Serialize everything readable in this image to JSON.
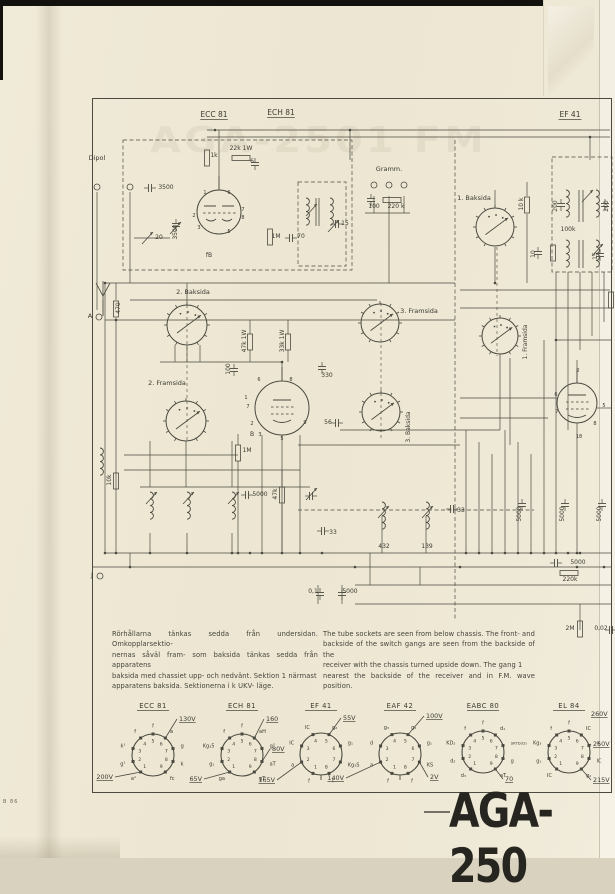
{
  "page": {
    "model": "AGA-250",
    "edge_code": "B 86",
    "bleed_text": "AGA-2501 FM"
  },
  "notes": {
    "swedish": "Rörhållarna tänkas sedda från undersidan. Omkopplarsektio-\nnernas såväl fram- som baksida tänkas sedda från apparatens\nbaksida med chassiet upp- och nedvänt.  Sektion 1 närmast\napparatens baksida.  Sektionerna i k  UKV- läge.",
    "english": "The tube sockets are seen from below chassis. The front- and\nbackside of the switch gangs are seen from the backside of the\nreceiver with the chassis turned upside down.  The gang 1\nnearest the backside of the receiver and in F.M. wave position."
  },
  "schematic": {
    "labels": [
      {
        "t": "ECC 81",
        "x": 214,
        "y": 117,
        "fs": 7.5,
        "u": 1
      },
      {
        "t": "ECH 81",
        "x": 281,
        "y": 115,
        "fs": 7.5,
        "u": 1
      },
      {
        "t": "EF 41",
        "x": 570,
        "y": 117,
        "fs": 7.5,
        "u": 1
      },
      {
        "t": "Dipol",
        "x": 97,
        "y": 160,
        "fs": 6.5
      },
      {
        "t": "Gramm.",
        "x": 389,
        "y": 171,
        "fs": 6.5
      },
      {
        "t": "100",
        "x": 374,
        "y": 208,
        "fs": 6
      },
      {
        "t": "220 k",
        "x": 396,
        "y": 208,
        "fs": 6
      },
      {
        "t": "1k",
        "x": 214,
        "y": 157,
        "fs": 6
      },
      {
        "t": "22k 1W",
        "x": 241,
        "y": 150,
        "fs": 6
      },
      {
        "t": "6",
        "x": 252,
        "y": 163,
        "fs": 6
      },
      {
        "t": "3500",
        "x": 166,
        "y": 189,
        "fs": 6
      },
      {
        "t": "3500",
        "x": 177,
        "y": 232,
        "fs": 6,
        "rot": 1
      },
      {
        "t": "20",
        "x": 159,
        "y": 239,
        "fs": 6
      },
      {
        "t": "1M",
        "x": 276,
        "y": 238,
        "fs": 6
      },
      {
        "t": "70",
        "x": 301,
        "y": 238,
        "fs": 6
      },
      {
        "t": "15",
        "x": 345,
        "y": 225,
        "fs": 6
      },
      {
        "t": "1. Baksida",
        "x": 474,
        "y": 200,
        "fs": 6.5
      },
      {
        "t": "10 k",
        "x": 523,
        "y": 204,
        "fs": 6,
        "rot": 1
      },
      {
        "t": "200",
        "x": 557,
        "y": 206,
        "fs": 6,
        "rot": 1
      },
      {
        "t": "200",
        "x": 608,
        "y": 206,
        "fs": 6,
        "rot": 1
      },
      {
        "t": "100k",
        "x": 568,
        "y": 231,
        "fs": 6
      },
      {
        "t": "10",
        "x": 535,
        "y": 254,
        "fs": 6,
        "rot": 1
      },
      {
        "t": "15",
        "x": 597,
        "y": 256,
        "fs": 6,
        "rot": 1
      },
      {
        "t": "470",
        "x": 120,
        "y": 308,
        "fs": 6,
        "rot": 1
      },
      {
        "t": "A",
        "x": 90,
        "y": 318,
        "fs": 6.5
      },
      {
        "t": "2. Baksida",
        "x": 193,
        "y": 294,
        "fs": 6.5
      },
      {
        "t": "3. Framsida",
        "x": 419,
        "y": 313,
        "fs": 6.5
      },
      {
        "t": "1. Framsida",
        "x": 527,
        "y": 342,
        "fs": 6,
        "rot": 1
      },
      {
        "t": "47k 1W",
        "x": 246,
        "y": 341,
        "fs": 6,
        "rot": 1
      },
      {
        "t": "33k 1W",
        "x": 284,
        "y": 341,
        "fs": 6,
        "rot": 1
      },
      {
        "t": "100",
        "x": 230,
        "y": 369,
        "fs": 6,
        "rot": 1
      },
      {
        "t": "330",
        "x": 327,
        "y": 377,
        "fs": 6
      },
      {
        "t": "2. Framsida",
        "x": 167,
        "y": 385,
        "fs": 6.5
      },
      {
        "t": "3. Baksida",
        "x": 410,
        "y": 427,
        "fs": 6,
        "rot": 1
      },
      {
        "t": "56",
        "x": 328,
        "y": 424,
        "fs": 6
      },
      {
        "t": "B",
        "x": 252,
        "y": 436,
        "fs": 6
      },
      {
        "t": "1M",
        "x": 247,
        "y": 452,
        "fs": 6
      },
      {
        "t": "fB",
        "x": 209,
        "y": 257,
        "fs": 6
      },
      {
        "t": "5000",
        "x": 260,
        "y": 496,
        "fs": 6
      },
      {
        "t": "47k",
        "x": 277,
        "y": 494,
        "fs": 6,
        "rot": 1
      },
      {
        "t": "10k",
        "x": 111,
        "y": 480,
        "fs": 6,
        "rot": 1
      },
      {
        "t": "33",
        "x": 333,
        "y": 534,
        "fs": 6
      },
      {
        "t": "432",
        "x": 384,
        "y": 548,
        "fs": 6
      },
      {
        "t": "139",
        "x": 427,
        "y": 548,
        "fs": 6
      },
      {
        "t": "33",
        "x": 461,
        "y": 512,
        "fs": 6
      },
      {
        "t": "5000",
        "x": 521,
        "y": 514,
        "fs": 6,
        "rot": 1
      },
      {
        "t": "5000",
        "x": 564,
        "y": 514,
        "fs": 6,
        "rot": 1
      },
      {
        "t": "5000",
        "x": 601,
        "y": 514,
        "fs": 6,
        "rot": 1
      },
      {
        "t": "5000",
        "x": 578,
        "y": 564,
        "fs": 6
      },
      {
        "t": "220k",
        "x": 570,
        "y": 581,
        "fs": 6
      },
      {
        "t": "2M",
        "x": 570,
        "y": 630,
        "fs": 6
      },
      {
        "t": "0,02",
        "x": 601,
        "y": 630,
        "fs": 6
      },
      {
        "t": "0,1",
        "x": 313,
        "y": 593,
        "fs": 6
      },
      {
        "t": "5000",
        "x": 350,
        "y": 593,
        "fs": 6
      },
      {
        "t": "J",
        "x": 92,
        "y": 577,
        "fs": 6.5
      },
      {
        "t": "1",
        "x": 205,
        "y": 194,
        "fs": 5
      },
      {
        "t": "6",
        "x": 229,
        "y": 194,
        "fs": 5
      },
      {
        "t": "7",
        "x": 243,
        "y": 211,
        "fs": 5
      },
      {
        "t": "8",
        "x": 243,
        "y": 219,
        "fs": 5
      },
      {
        "t": "2",
        "x": 194,
        "y": 217,
        "fs": 5
      },
      {
        "t": "3",
        "x": 199,
        "y": 229,
        "fs": 5
      },
      {
        "t": "5",
        "x": 229,
        "y": 233,
        "fs": 5
      },
      {
        "t": "6",
        "x": 259,
        "y": 381,
        "fs": 5
      },
      {
        "t": "8",
        "x": 291,
        "y": 381,
        "fs": 5
      },
      {
        "t": "1",
        "x": 246,
        "y": 399,
        "fs": 5
      },
      {
        "t": "7",
        "x": 248,
        "y": 408,
        "fs": 5
      },
      {
        "t": "2",
        "x": 252,
        "y": 425,
        "fs": 5
      },
      {
        "t": "3",
        "x": 260,
        "y": 436,
        "fs": 5
      },
      {
        "t": "5",
        "x": 282,
        "y": 440,
        "fs": 5
      },
      {
        "t": "9",
        "x": 305,
        "y": 424,
        "fs": 5
      },
      {
        "t": "2",
        "x": 578,
        "y": 372,
        "fs": 5
      },
      {
        "t": "5",
        "x": 604,
        "y": 407,
        "fs": 5
      },
      {
        "t": "6",
        "x": 556,
        "y": 396,
        "fs": 5
      },
      {
        "t": "7",
        "x": 557,
        "y": 413,
        "fs": 5
      },
      {
        "t": "8",
        "x": 595,
        "y": 425,
        "fs": 5
      },
      {
        "t": "18",
        "x": 579,
        "y": 438,
        "fs": 5
      }
    ]
  },
  "sockets": [
    {
      "id": "ecc81",
      "title": "ECC 81",
      "cx": 153,
      "cy": 755,
      "type": 9,
      "pins": {
        "1": "a¹",
        "2": "g¹",
        "3": "k¹",
        "4": "f",
        "5": "f",
        "6": "a",
        "7": "g",
        "8": "k",
        "9": "fc"
      },
      "volts": [
        {
          "t": "130V",
          "pin": 6,
          "tx": 26,
          "ty": -34
        },
        {
          "t": "200V",
          "pin": 1,
          "tx": -40,
          "ty": 24
        }
      ]
    },
    {
      "id": "ech81",
      "title": "ECH 81",
      "cx": 242,
      "cy": 755,
      "type": 9,
      "pins": {
        "1": "ga",
        "2": "g₁",
        "3": "Kg₃5",
        "4": "f",
        "5": "f",
        "6": "aH",
        "7": "g³",
        "8": "aT",
        "9": "gT"
      },
      "volts": [
        {
          "t": "160",
          "pin": 6,
          "tx": 24,
          "ty": -34
        },
        {
          "t": "80V",
          "pin": 8,
          "tx": 30,
          "ty": -4
        },
        {
          "t": "65V",
          "pin": 1,
          "tx": -40,
          "ty": 26
        }
      ]
    },
    {
      "id": "ef41",
      "title": "EF 41",
      "cx": 321,
      "cy": 754,
      "type": 8,
      "pins": {
        "1": "f",
        "2": "a",
        "3": "IC",
        "4": "IC",
        "5": "g₂",
        "6": "g₁",
        "7": "Kg₃S",
        "8": "f"
      },
      "volts": [
        {
          "t": "55V",
          "pin": 5,
          "tx": 22,
          "ty": -34
        },
        {
          "t": "165V",
          "pin": 2,
          "tx": -46,
          "ty": 28
        }
      ]
    },
    {
      "id": "eaf42",
      "title": "EAF 42",
      "cx": 400,
      "cy": 754,
      "type": 8,
      "pins": {
        "1": "f",
        "2": "a",
        "3": "d",
        "4": "g₃",
        "5": "g₂",
        "6": "g₁",
        "7": "KS",
        "8": "f"
      },
      "volts": [
        {
          "t": "100V",
          "pin": 5,
          "tx": 26,
          "ty": -36
        },
        {
          "t": "140V",
          "pin": 2,
          "tx": -56,
          "ty": 26
        },
        {
          "t": "2V",
          "pin": 7,
          "tx": 30,
          "ty": 25
        }
      ]
    },
    {
      "id": "eabc80",
      "title": "EABC 80",
      "cx": 483,
      "cy": 752,
      "type": 9,
      "pins": {
        "1": "d₃",
        "2": "d₂",
        "3": "KD₂",
        "4": "f",
        "5": "f",
        "6": "d₁",
        "7": "SKTD₁D₃",
        "8": "g",
        "9": "aT"
      },
      "volts": [
        {
          "t": "70",
          "pin": 9,
          "tx": 22,
          "ty": 29
        }
      ]
    },
    {
      "id": "el84",
      "title": "EL 84",
      "cx": 569,
      "cy": 752,
      "type": 9,
      "pins": {
        "1": "IC",
        "2": "g₁",
        "3": "Kg₃",
        "4": "f",
        "5": "f",
        "6": "IC",
        "7": "a",
        "8": "IC",
        "9": "g₂"
      },
      "volts": [
        {
          "t": "250V",
          "pin": 7,
          "tx": 24,
          "ty": -6
        },
        {
          "t": "215V",
          "pin": 9,
          "tx": 24,
          "ty": 30
        },
        {
          "t": "260V",
          "pin": 6,
          "tx": 22,
          "ty": -36,
          "noline": 1
        }
      ]
    }
  ]
}
